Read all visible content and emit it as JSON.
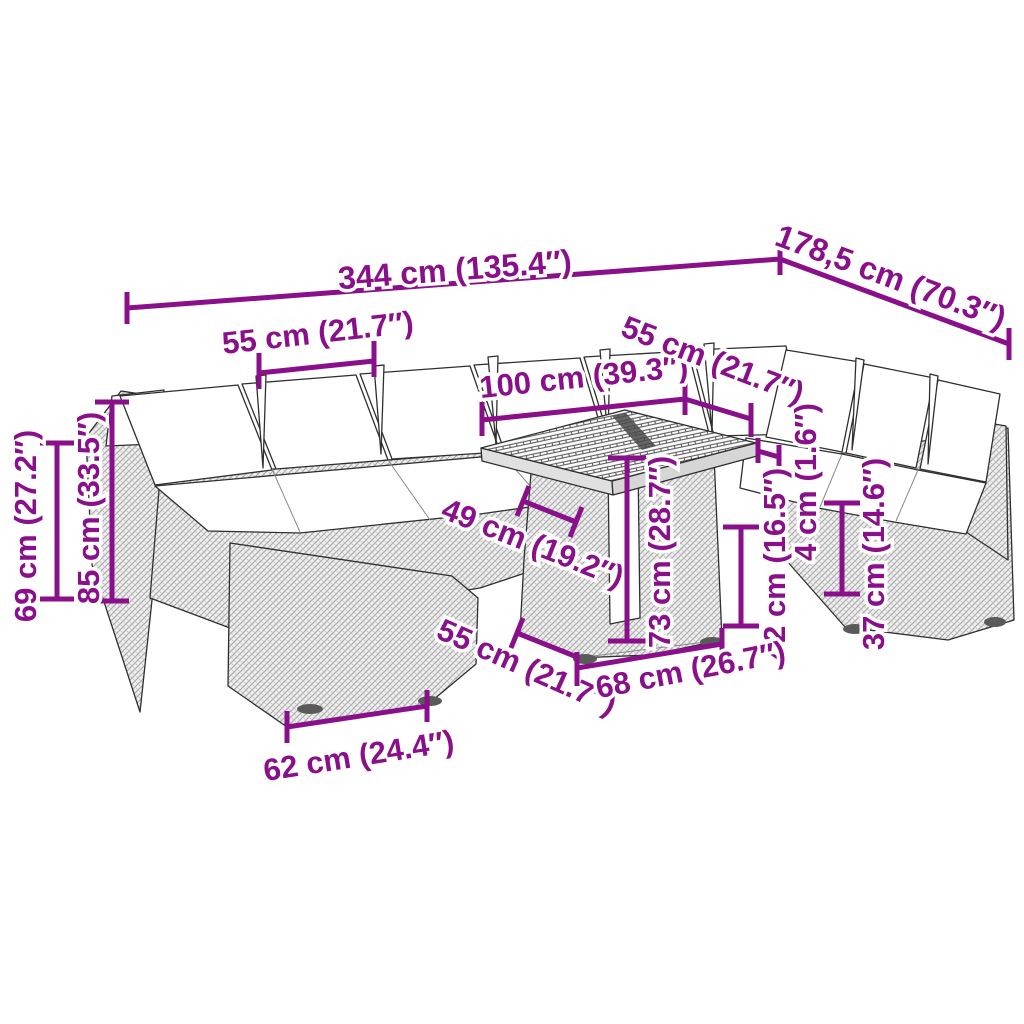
{
  "diagram": {
    "kind": "product-dimension-diagram",
    "background_color": "#ffffff",
    "line_art_color": "#2f2f2f",
    "dimension_color": "#8A0F8A"
  },
  "dimensions": [
    {
      "id": "overall-width",
      "label": "344 cm (135.4″)"
    },
    {
      "id": "overall-depth",
      "label": "178,5 cm (70.3″)"
    },
    {
      "id": "seat-width-left",
      "label": "55 cm (21.7″)"
    },
    {
      "id": "table-length",
      "label": "100 cm (39.3″)"
    },
    {
      "id": "seat-width-right",
      "label": "55 cm (21.7″)"
    },
    {
      "id": "height-69",
      "label": "69 cm (27.2″)"
    },
    {
      "id": "height-85",
      "label": "85 cm (33.5″)"
    },
    {
      "id": "seat-depth-49",
      "label": "49 cm (19.2″)"
    },
    {
      "id": "table-height-73",
      "label": "73 cm (28.7″)"
    },
    {
      "id": "thickness-4",
      "label": "4 cm (1.6″)"
    },
    {
      "id": "height-42",
      "label": "42 cm (16.5″)"
    },
    {
      "id": "height-37",
      "label": "37 cm (14.6″)"
    },
    {
      "id": "table-depth-55",
      "label": "55 cm (21.7″)"
    },
    {
      "id": "base-length-68",
      "label": "68 cm (26.7″)"
    },
    {
      "id": "module-width-62",
      "label": "62 cm (24.4″)"
    }
  ]
}
